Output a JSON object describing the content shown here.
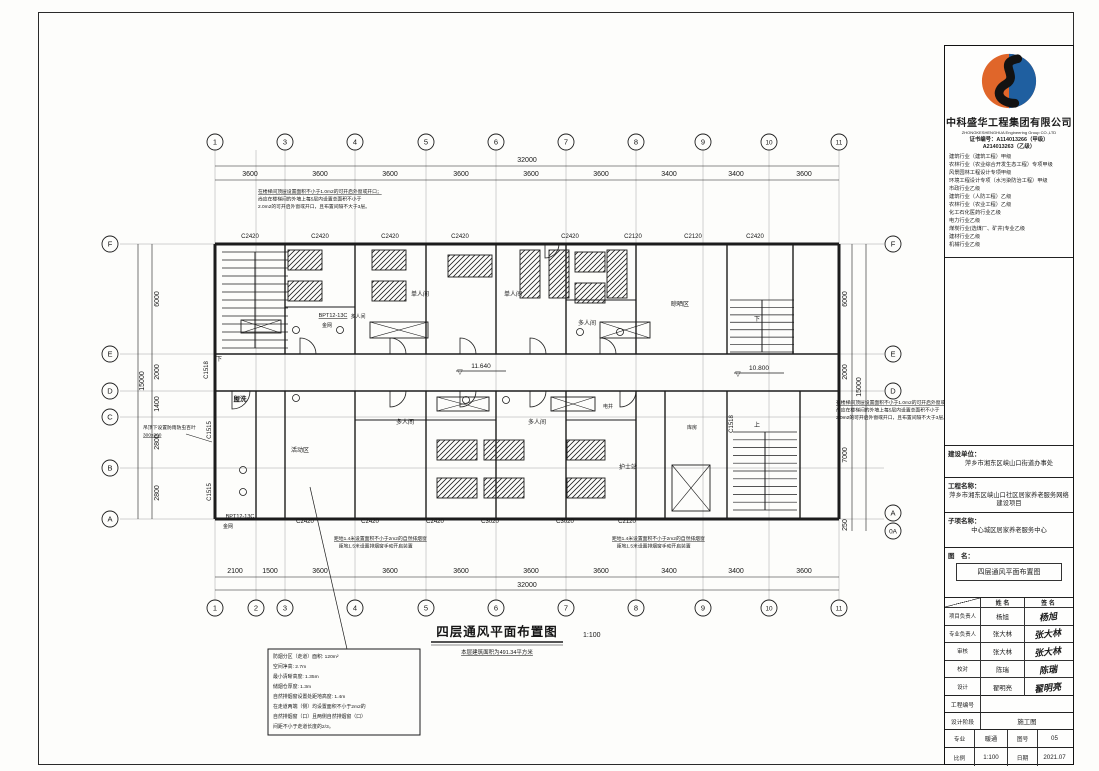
{
  "colors": {
    "brand_orange": "#e0662a",
    "brand_blue": "#1f5fa0",
    "ink": "#1c1c1c",
    "paper": "#fdfdfb"
  },
  "title_block": {
    "company_cn": "中科盛华工程集团有限公司",
    "company_en": "ZHONGKESHENGHUA Engineering Group CO.,LTD",
    "cert_line1": "证书编号：A114013266（甲级）",
    "cert_line2": "A214013263（乙级）",
    "qualifications": [
      "建筑行业（建筑工程）甲级",
      "农林行业（农业综合开发生态工程）专项甲级",
      "风景园林工程设计专项甲级",
      "环境工程设计专项（水污染防治工程）甲级",
      "市政行业乙级",
      "建筑行业（人防工程）乙级",
      "农林行业（农业工程）乙级",
      "化工石化医药行业乙级",
      "电力行业乙级",
      "煤炭行业(选煤厂、矿井)专业乙级",
      "建材行业乙级",
      "机械行业乙级"
    ],
    "owner_label": "建设单位：",
    "owner": "萍乡市湘东区峡山口街道办事处",
    "project_label": "工程名称：",
    "project": "萍乡市湘东区峡山口社区居家养老服务网络建设项目",
    "subproject_label": "子项名称：",
    "subproject": "中心城区居家养老服务中心",
    "dwg_label": "图　名：",
    "dwg_name": "四层通风平面布置图",
    "col_name": "姓 名",
    "col_sign": "签 名",
    "sign_rows": [
      {
        "role": "项目负责人",
        "name": "杨旭",
        "sig": "杨旭"
      },
      {
        "role": "专业负责人",
        "name": "张大林",
        "sig": "张大林"
      },
      {
        "role": "审核",
        "name": "张大林",
        "sig": "张大林"
      },
      {
        "role": "校对",
        "name": "陈瑞",
        "sig": "陈瑞"
      },
      {
        "role": "设计",
        "name": "翟明亮",
        "sig": "翟明亮"
      }
    ],
    "project_no_label": "工程编号",
    "project_no": "",
    "stage_label": "设计阶段",
    "stage": "施工图",
    "major_label": "专业",
    "major": "暖通",
    "fig_label": "图号",
    "fig_no": "05",
    "scale_label": "比例",
    "scale": "1:100",
    "date_label": "日期",
    "date": "2021.07"
  },
  "drawing_title": {
    "text": "四层通风平面布置图",
    "scale": "1:100",
    "sub": "本层建筑面积为491.34平方米",
    "x": 497,
    "y": 636
  },
  "plan": {
    "grid": {
      "vxs": [
        215,
        256,
        285,
        355,
        426,
        496,
        566,
        636,
        703,
        769,
        839
      ],
      "hys": [
        244,
        354,
        391,
        417,
        468,
        519
      ]
    },
    "axis_circles": [
      {
        "t": "1",
        "x": 215,
        "y": 142
      },
      {
        "t": "3",
        "x": 285,
        "y": 142
      },
      {
        "t": "4",
        "x": 355,
        "y": 142
      },
      {
        "t": "5",
        "x": 426,
        "y": 142
      },
      {
        "t": "6",
        "x": 496,
        "y": 142
      },
      {
        "t": "7",
        "x": 566,
        "y": 142
      },
      {
        "t": "8",
        "x": 636,
        "y": 142
      },
      {
        "t": "9",
        "x": 703,
        "y": 142
      },
      {
        "t": "10",
        "x": 769,
        "y": 142
      },
      {
        "t": "11",
        "x": 839,
        "y": 142
      },
      {
        "t": "1",
        "x": 215,
        "y": 608
      },
      {
        "t": "2",
        "x": 256,
        "y": 608
      },
      {
        "t": "3",
        "x": 285,
        "y": 608
      },
      {
        "t": "4",
        "x": 355,
        "y": 608
      },
      {
        "t": "5",
        "x": 426,
        "y": 608
      },
      {
        "t": "6",
        "x": 496,
        "y": 608
      },
      {
        "t": "7",
        "x": 566,
        "y": 608
      },
      {
        "t": "8",
        "x": 636,
        "y": 608
      },
      {
        "t": "9",
        "x": 703,
        "y": 608
      },
      {
        "t": "10",
        "x": 769,
        "y": 608
      },
      {
        "t": "11",
        "x": 839,
        "y": 608
      },
      {
        "t": "F",
        "x": 110,
        "y": 244
      },
      {
        "t": "E",
        "x": 110,
        "y": 354
      },
      {
        "t": "D",
        "x": 110,
        "y": 391
      },
      {
        "t": "C",
        "x": 110,
        "y": 417
      },
      {
        "t": "B",
        "x": 110,
        "y": 468
      },
      {
        "t": "A",
        "x": 110,
        "y": 519
      },
      {
        "t": "F",
        "x": 893,
        "y": 244
      },
      {
        "t": "E",
        "x": 893,
        "y": 354
      },
      {
        "t": "D",
        "x": 893,
        "y": 391
      },
      {
        "t": "A",
        "x": 893,
        "y": 513
      },
      {
        "t": "0A",
        "x": 893,
        "y": 531
      }
    ],
    "lines": [
      [
        215,
        166,
        839,
        166,
        0.6
      ],
      [
        215,
        180,
        839,
        180,
        0.6
      ],
      [
        215,
        577,
        839,
        577,
        0.6
      ],
      [
        215,
        590,
        839,
        590,
        0.6
      ],
      [
        152,
        244,
        152,
        519,
        0.6
      ],
      [
        138,
        244,
        138,
        519,
        0.6
      ],
      [
        852,
        244,
        852,
        531,
        0.6
      ],
      [
        866,
        244,
        866,
        531,
        0.6
      ],
      [
        215,
        244,
        839,
        244,
        3
      ],
      [
        215,
        519,
        839,
        519,
        3
      ],
      [
        215,
        244,
        215,
        519,
        3
      ],
      [
        839,
        244,
        839,
        519,
        3
      ],
      [
        215,
        354,
        839,
        354,
        1.4
      ],
      [
        215,
        391,
        839,
        391,
        1.4
      ],
      [
        285,
        244,
        285,
        354,
        1.4
      ],
      [
        355,
        244,
        355,
        354,
        1.4
      ],
      [
        426,
        244,
        426,
        354,
        1.4
      ],
      [
        496,
        244,
        496,
        354,
        1.4
      ],
      [
        566,
        244,
        566,
        354,
        1.4
      ],
      [
        636,
        244,
        636,
        354,
        1.4
      ],
      [
        727,
        244,
        727,
        354,
        1.4
      ],
      [
        793,
        244,
        793,
        354,
        1.4
      ],
      [
        256,
        391,
        256,
        519,
        1.4
      ],
      [
        285,
        391,
        285,
        519,
        1.4
      ],
      [
        355,
        391,
        355,
        519,
        1.4
      ],
      [
        426,
        391,
        426,
        519,
        1.4
      ],
      [
        496,
        391,
        496,
        519,
        1.4
      ],
      [
        566,
        391,
        566,
        519,
        1.4
      ],
      [
        636,
        391,
        636,
        519,
        1.4
      ],
      [
        665,
        391,
        665,
        519,
        1.4
      ],
      [
        727,
        391,
        727,
        519,
        1.4
      ],
      [
        800,
        391,
        800,
        519,
        1.4
      ],
      [
        285,
        307,
        355,
        307,
        0.9
      ],
      [
        566,
        300,
        636,
        300,
        0.9
      ],
      [
        355,
        420,
        496,
        420,
        0.9
      ],
      [
        566,
        420,
        636,
        420,
        0.9
      ],
      [
        255,
        252,
        255,
        348,
        1
      ],
      [
        762,
        300,
        762,
        352,
        1
      ],
      [
        765,
        432,
        765,
        510,
        1
      ],
      [
        456,
        371,
        506,
        371,
        0.7
      ],
      [
        734,
        373,
        784,
        373,
        0.7
      ],
      [
        347,
        649,
        310,
        487,
        0.7
      ],
      [
        186,
        434,
        212,
        442,
        0.6
      ]
    ],
    "stairs": [
      {
        "x": 222,
        "y": 252,
        "w": 66,
        "h": 96,
        "n": 13
      },
      {
        "x": 730,
        "y": 300,
        "w": 64,
        "h": 52,
        "n": 8
      },
      {
        "x": 733,
        "y": 432,
        "w": 64,
        "h": 78,
        "n": 11
      }
    ],
    "beds": [
      [
        288,
        250,
        34,
        20
      ],
      [
        288,
        281,
        34,
        20
      ],
      [
        372,
        250,
        34,
        20
      ],
      [
        372,
        281,
        34,
        20
      ],
      [
        448,
        255,
        44,
        22
      ],
      [
        520,
        250,
        20,
        48
      ],
      [
        549,
        250,
        20,
        48
      ],
      [
        575,
        252,
        30,
        20
      ],
      [
        575,
        283,
        30,
        20
      ],
      [
        607,
        250,
        20,
        48
      ],
      [
        437,
        440,
        40,
        20
      ],
      [
        437,
        478,
        40,
        20
      ],
      [
        484,
        440,
        40,
        20
      ],
      [
        484,
        478,
        40,
        20
      ],
      [
        567,
        440,
        38,
        20
      ],
      [
        567,
        478,
        38,
        20
      ]
    ],
    "crosses": [
      [
        370,
        322,
        58,
        16
      ],
      [
        437,
        397,
        52,
        14
      ],
      [
        551,
        397,
        44,
        14
      ],
      [
        600,
        322,
        50,
        16
      ],
      [
        672,
        465,
        38,
        46
      ],
      [
        241,
        320,
        40,
        13
      ]
    ],
    "fixtures": [
      [
        296,
        330
      ],
      [
        340,
        330
      ],
      [
        580,
        332
      ],
      [
        620,
        332
      ],
      [
        466,
        400
      ],
      [
        506,
        400
      ],
      [
        243,
        470
      ],
      [
        243,
        492
      ],
      [
        296,
        398
      ]
    ],
    "arcs": [
      {
        "x": 300,
        "y": 354,
        "r": 16,
        "o": "up"
      },
      {
        "x": 390,
        "y": 354,
        "r": 16,
        "o": "up"
      },
      {
        "x": 460,
        "y": 354,
        "r": 16,
        "o": "up"
      },
      {
        "x": 530,
        "y": 354,
        "r": 16,
        "o": "up"
      },
      {
        "x": 600,
        "y": 354,
        "r": 16,
        "o": "up"
      },
      {
        "x": 390,
        "y": 391,
        "r": 16,
        "o": "down"
      },
      {
        "x": 460,
        "y": 391,
        "r": 16,
        "o": "down"
      },
      {
        "x": 530,
        "y": 391,
        "r": 16,
        "o": "down"
      },
      {
        "x": 620,
        "y": 391,
        "r": 16,
        "o": "down"
      },
      {
        "x": 232,
        "y": 391,
        "r": 18,
        "o": "down"
      },
      {
        "x": 545,
        "y": 244,
        "r": 14,
        "o": "down"
      }
    ],
    "texts": [
      {
        "t": "3600",
        "x": 250,
        "y": 176,
        "s": 7
      },
      {
        "t": "3600",
        "x": 320,
        "y": 176,
        "s": 7
      },
      {
        "t": "3600",
        "x": 390,
        "y": 176,
        "s": 7
      },
      {
        "t": "3600",
        "x": 461,
        "y": 176,
        "s": 7
      },
      {
        "t": "3600",
        "x": 531,
        "y": 176,
        "s": 7
      },
      {
        "t": "3600",
        "x": 601,
        "y": 176,
        "s": 7
      },
      {
        "t": "3400",
        "x": 669,
        "y": 176,
        "s": 7
      },
      {
        "t": "3400",
        "x": 736,
        "y": 176,
        "s": 7
      },
      {
        "t": "3600",
        "x": 804,
        "y": 176,
        "s": 7
      },
      {
        "t": "32000",
        "x": 527,
        "y": 162,
        "s": 7
      },
      {
        "t": "2100",
        "x": 235,
        "y": 573,
        "s": 7
      },
      {
        "t": "1500",
        "x": 270,
        "y": 573,
        "s": 7
      },
      {
        "t": "3600",
        "x": 320,
        "y": 573,
        "s": 7
      },
      {
        "t": "3600",
        "x": 390,
        "y": 573,
        "s": 7
      },
      {
        "t": "3600",
        "x": 461,
        "y": 573,
        "s": 7
      },
      {
        "t": "3600",
        "x": 531,
        "y": 573,
        "s": 7
      },
      {
        "t": "3600",
        "x": 601,
        "y": 573,
        "s": 7
      },
      {
        "t": "3400",
        "x": 669,
        "y": 573,
        "s": 7
      },
      {
        "t": "3400",
        "x": 736,
        "y": 573,
        "s": 7
      },
      {
        "t": "3600",
        "x": 804,
        "y": 573,
        "s": 7
      },
      {
        "t": "32000",
        "x": 527,
        "y": 587,
        "s": 7
      },
      {
        "t": "6000",
        "x": 159,
        "y": 299,
        "s": 7,
        "r": -90
      },
      {
        "t": "2000",
        "x": 159,
        "y": 372,
        "s": 7,
        "r": -90
      },
      {
        "t": "1400",
        "x": 159,
        "y": 404,
        "s": 7,
        "r": -90
      },
      {
        "t": "2800",
        "x": 159,
        "y": 442,
        "s": 7,
        "r": -90
      },
      {
        "t": "2800",
        "x": 159,
        "y": 493,
        "s": 7,
        "r": -90
      },
      {
        "t": "15000",
        "x": 144,
        "y": 381,
        "s": 7,
        "r": -90
      },
      {
        "t": "6000",
        "x": 847,
        "y": 299,
        "s": 7,
        "r": -90
      },
      {
        "t": "2000",
        "x": 847,
        "y": 372,
        "s": 7,
        "r": -90
      },
      {
        "t": "7000",
        "x": 847,
        "y": 455,
        "s": 7,
        "r": -90
      },
      {
        "t": "250",
        "x": 847,
        "y": 525,
        "s": 7,
        "r": -90
      },
      {
        "t": "15000",
        "x": 861,
        "y": 387,
        "s": 7,
        "r": -90
      },
      {
        "t": "C2420",
        "x": 250,
        "y": 238,
        "s": 6
      },
      {
        "t": "C2420",
        "x": 320,
        "y": 238,
        "s": 6
      },
      {
        "t": "C2420",
        "x": 390,
        "y": 238,
        "s": 6
      },
      {
        "t": "C2420",
        "x": 460,
        "y": 238,
        "s": 6
      },
      {
        "t": "C2420",
        "x": 570,
        "y": 238,
        "s": 6
      },
      {
        "t": "C2120",
        "x": 633,
        "y": 238,
        "s": 6
      },
      {
        "t": "C2120",
        "x": 693,
        "y": 238,
        "s": 6
      },
      {
        "t": "C2420",
        "x": 755,
        "y": 238,
        "s": 6
      },
      {
        "t": "C2420",
        "x": 305,
        "y": 523,
        "s": 6
      },
      {
        "t": "C2420",
        "x": 370,
        "y": 523,
        "s": 6
      },
      {
        "t": "C2420",
        "x": 435,
        "y": 523,
        "s": 6
      },
      {
        "t": "C3020",
        "x": 490,
        "y": 523,
        "s": 6
      },
      {
        "t": "C3020",
        "x": 565,
        "y": 523,
        "s": 6
      },
      {
        "t": "C2120",
        "x": 627,
        "y": 523,
        "s": 6
      },
      {
        "t": "C1518",
        "x": 208,
        "y": 370,
        "s": 6,
        "r": -90
      },
      {
        "t": "C1515",
        "x": 211,
        "y": 430,
        "s": 6,
        "r": -90
      },
      {
        "t": "C1515",
        "x": 211,
        "y": 492,
        "s": 6,
        "r": -90
      },
      {
        "t": "C1518",
        "x": 733,
        "y": 424,
        "s": 6,
        "r": -90
      },
      {
        "t": "多人间",
        "x": 358,
        "y": 318,
        "s": 5
      },
      {
        "t": "单人间",
        "x": 420,
        "y": 296,
        "s": 6
      },
      {
        "t": "单人间",
        "x": 513,
        "y": 296,
        "s": 6
      },
      {
        "t": "多人间",
        "x": 587,
        "y": 325,
        "s": 6
      },
      {
        "t": "晾晒区",
        "x": 680,
        "y": 306,
        "s": 6
      },
      {
        "t": "多人间",
        "x": 405,
        "y": 424,
        "s": 6
      },
      {
        "t": "多人间",
        "x": 537,
        "y": 424,
        "s": 6
      },
      {
        "t": "护士站",
        "x": 628,
        "y": 469,
        "s": 6
      },
      {
        "t": "电井",
        "x": 608,
        "y": 408,
        "s": 5
      },
      {
        "t": "库房",
        "x": 692,
        "y": 429,
        "s": 5
      },
      {
        "t": "盥洗",
        "x": 240,
        "y": 401,
        "s": 6.5,
        "b": 1
      },
      {
        "t": "活动区",
        "x": 300,
        "y": 452,
        "s": 6
      },
      {
        "t": "BPT12-13C",
        "x": 333,
        "y": 317,
        "s": 5.5,
        "u": 1
      },
      {
        "t": "金网",
        "x": 327,
        "y": 327,
        "s": 5
      },
      {
        "t": "BPT12-13C",
        "x": 240,
        "y": 518,
        "s": 5.5,
        "u": 1
      },
      {
        "t": "金网",
        "x": 228,
        "y": 528,
        "s": 5
      },
      {
        "t": "11.640",
        "x": 481,
        "y": 368,
        "s": 6.5
      },
      {
        "t": "▽",
        "x": 460,
        "y": 374,
        "s": 7
      },
      {
        "t": "10.800",
        "x": 759,
        "y": 370,
        "s": 6.5
      },
      {
        "t": "▽",
        "x": 738,
        "y": 376,
        "s": 7
      },
      {
        "t": "下",
        "x": 219,
        "y": 361,
        "s": 6
      },
      {
        "t": "下",
        "x": 757,
        "y": 321,
        "s": 6
      },
      {
        "t": "上",
        "x": 757,
        "y": 427,
        "s": 6
      }
    ],
    "notes": [
      {
        "x": 258,
        "y": 193,
        "s": 4.8,
        "lh": 7.5,
        "u": [
          0
        ],
        "lines": [
          "在楼梯间顶层设置面积不小于1.0m2的可开启外窗或开口；",
          "尚应在楼梯间的外墙上每5层内设置总面积不小于",
          "2.0m2的可开启外窗或开口，且布置间隔不大于3层。"
        ]
      },
      {
        "x": 836,
        "y": 404,
        "s": 4.8,
        "lh": 7.5,
        "u": [
          0
        ],
        "lines": [
          "在楼梯间顶层设置面积不小于1.0m2的可开启外窗或开口；",
          "尚应在楼梯间的外墙上每5层内设置总面积不小于",
          "2.0m2的可开启外窗或开口，且布置间隔不大于3层。"
        ]
      },
      {
        "x": 334,
        "y": 540,
        "s": 4.8,
        "lh": 7.5,
        "u": [
          0
        ],
        "lines": [
          "距地1.4米设置面积不小于2m2的自然排烟窗",
          "　距地1.5米设置排烟窗手动开启装置"
        ]
      },
      {
        "x": 612,
        "y": 540,
        "s": 4.8,
        "lh": 7.5,
        "u": [
          0
        ],
        "lines": [
          "距地1.4米设置面积不小于2m2的自然排烟窗",
          "　距地1.5米设置排烟窗手动开启装置"
        ]
      },
      {
        "x": 143,
        "y": 429,
        "s": 4.8,
        "lh": 7.5,
        "u": [
          1
        ],
        "lines": [
          "吊顶下设置防雨防虫百叶",
          "300x300"
        ]
      }
    ],
    "note_box": {
      "x": 268,
      "y": 649,
      "w": 152,
      "h": 86,
      "s": 4.9,
      "lh": 10,
      "lines": [
        "防烟分区（走道）面积: 120m²",
        "空间净高: 2.7m",
        "最小清晰高度: 1.35m",
        "储烟仓厚度: 1.3m",
        "自然排烟窗设置处距地高度: 1.4m",
        "在走道两端（侧）均设置面积不小于2m2的",
        "自然排烟窗（口）且两侧自然排烟窗（口）",
        "间距不小于走道长度的2/3。"
      ]
    }
  }
}
